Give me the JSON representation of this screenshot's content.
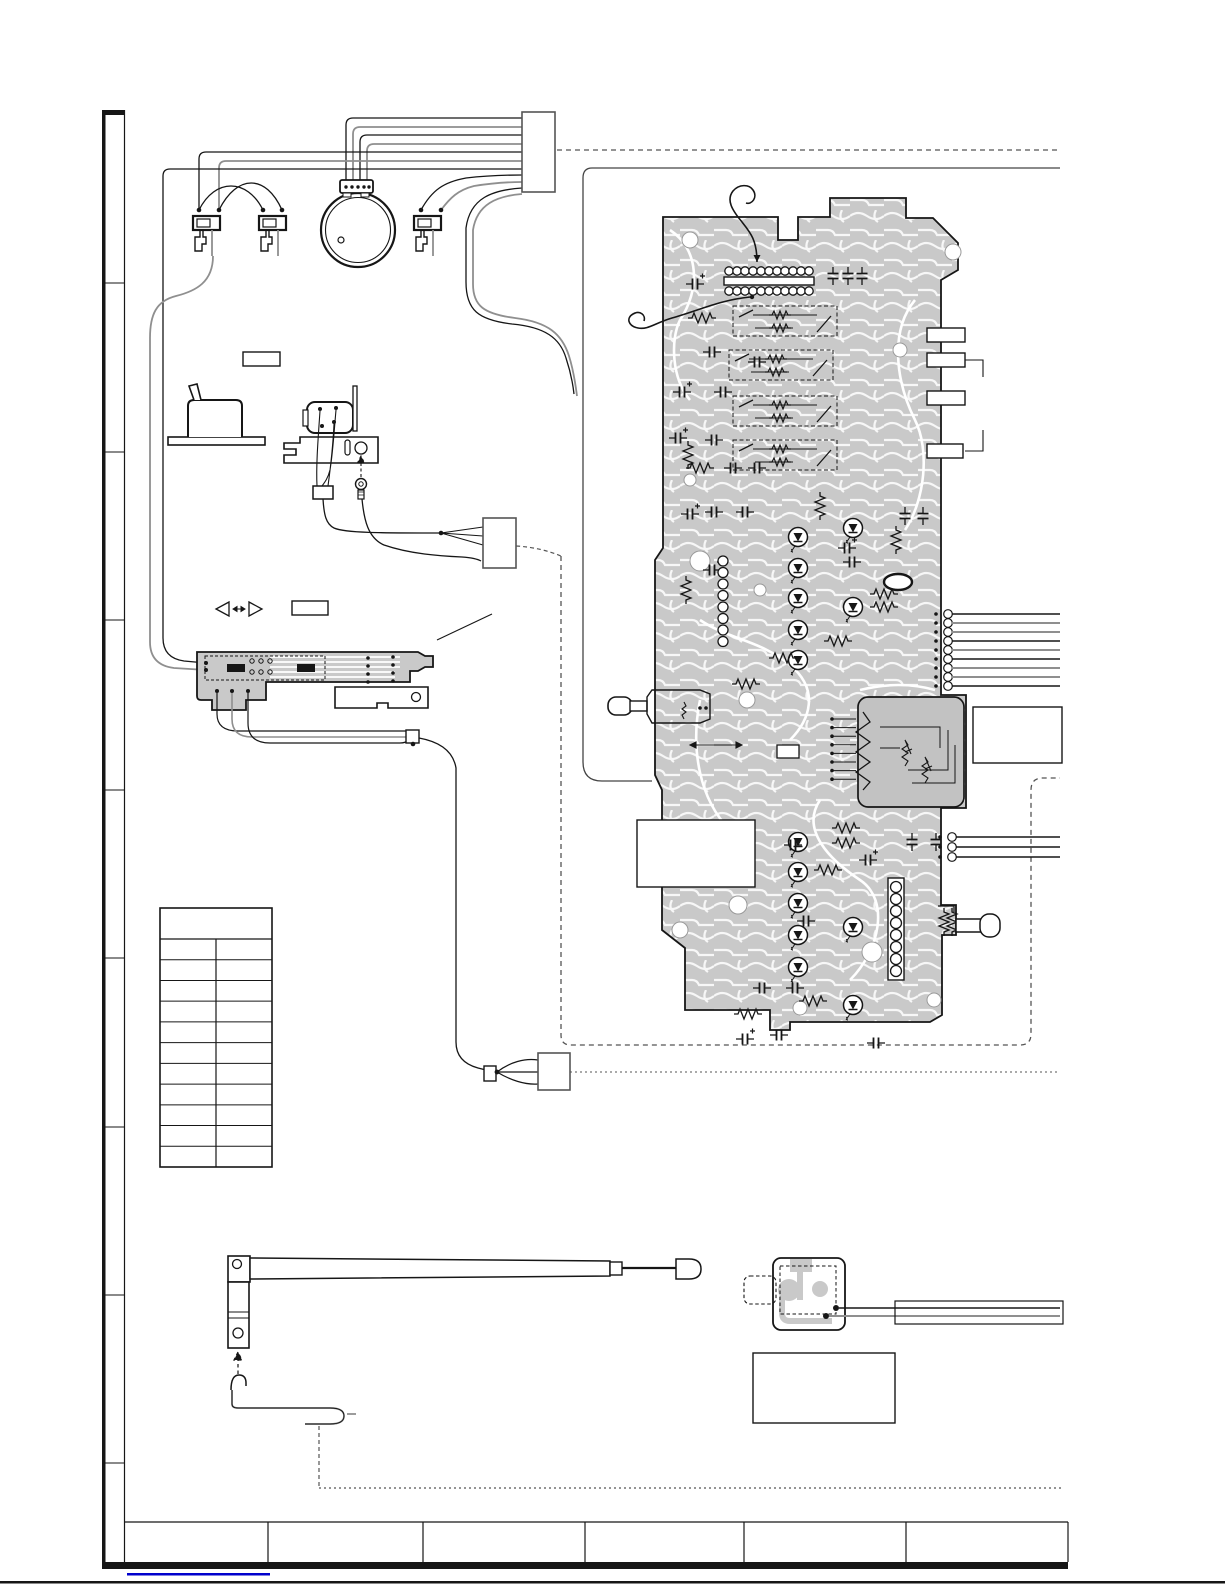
{
  "meta": {
    "kind": "service-manual-wiring-diagram-page",
    "visible_text": "",
    "page_width": 1225,
    "page_height": 1585
  },
  "colors": {
    "bg": "#ffffff",
    "ink": "#161616",
    "wire_gray": "#8f8f8f",
    "frame_gray": "#444444",
    "dash_gray": "#555555",
    "pcb_fill": "#c9c9c9",
    "pcb_block": "#c2c2c2",
    "trace_white": "#ffffff",
    "link_blue": "#0000cc"
  },
  "frame": {
    "strip_x": 102,
    "strip_x2": 124.5,
    "strip_top": 110,
    "strip_bottom": 1562,
    "dividers": [
      283,
      452,
      620,
      790,
      958,
      1127,
      1295,
      1463
    ],
    "footer": {
      "x1": 125,
      "x2": 1068,
      "y_top": 1522,
      "y_bottom": 1562,
      "dividers": [
        268,
        423,
        585,
        744,
        906
      ]
    },
    "bottom_bar": {
      "x1": 102,
      "x2": 1068,
      "y": 1562,
      "h": 7
    },
    "blue_line": {
      "x1": 127,
      "x2": 270,
      "y": 1573
    },
    "page_bottom_line_y": 1581
  },
  "ref_table": {
    "x": 160,
    "y": 908,
    "w": 112,
    "h": 259,
    "header_h": 31,
    "rows": 11,
    "col_split_x": 216,
    "cells_empty": true
  },
  "connectors": {
    "top": [
      522,
      112,
      33,
      80
    ],
    "mid": [
      483,
      518,
      33,
      50
    ],
    "lower": [
      538,
      1053,
      32,
      37
    ]
  },
  "label_boxes": [
    [
      243,
      352,
      37,
      14
    ],
    [
      292,
      601,
      36,
      14
    ],
    [
      927,
      328,
      38,
      14
    ],
    [
      927,
      353,
      38,
      14
    ],
    [
      927,
      391,
      38,
      14
    ],
    [
      927,
      444,
      36,
      14
    ],
    [
      973,
      707,
      89,
      56
    ],
    [
      637,
      820,
      118,
      67
    ],
    [
      753,
      1353,
      142,
      70
    ]
  ],
  "harness": {
    "wire_ys": [
      118,
      127,
      135,
      144,
      152,
      161,
      169
    ],
    "wire_colors": [
      "k",
      "g",
      "k",
      "g",
      "k",
      "g",
      "k"
    ],
    "motor_pins": [
      346,
      353,
      360,
      367
    ],
    "switch_dots": [
      [
        199,
        210
      ],
      [
        219,
        210
      ],
      [
        263,
        210
      ],
      [
        282,
        210
      ],
      [
        421,
        210
      ],
      [
        441,
        210
      ]
    ]
  },
  "bundles": [
    {
      "x": 948,
      "x_end": 1060,
      "ys": [
        614,
        623,
        632,
        641,
        650,
        659,
        668,
        677,
        686
      ],
      "colors": [
        "k",
        "g",
        "g",
        "k",
        "g",
        "k",
        "g",
        "g",
        "k"
      ]
    },
    {
      "x": 952,
      "x_end": 1060,
      "ys": [
        837,
        847,
        857
      ],
      "colors": [
        "k",
        "k",
        "k"
      ]
    }
  ],
  "leds": [
    [
      798,
      537
    ],
    [
      798,
      568
    ],
    [
      798,
      598
    ],
    [
      798,
      630
    ],
    [
      798,
      660
    ],
    [
      853,
      528
    ],
    [
      853,
      607
    ],
    [
      798,
      842
    ],
    [
      798,
      872
    ],
    [
      798,
      903
    ],
    [
      798,
      935
    ],
    [
      798,
      967
    ],
    [
      853,
      927
    ],
    [
      853,
      1005
    ]
  ],
  "pin_strip": {
    "x0": 729,
    "step": 8,
    "count": 11,
    "y_top": 271,
    "y_bot": 291,
    "bar": [
      724,
      277,
      90,
      8
    ]
  },
  "circle_cols": [
    {
      "x": 723,
      "y0": 561,
      "step": 11.5,
      "count": 8,
      "r": 5,
      "boxed": false
    },
    {
      "x": 896,
      "y0": 887,
      "step": 12,
      "count": 8,
      "r": 5.5,
      "boxed": true
    }
  ],
  "switch_rows": [
    [
      733,
      306
    ],
    [
      729,
      350
    ],
    [
      733,
      396
    ],
    [
      733,
      440
    ]
  ],
  "resistors": [
    [
      702,
      318,
      0
    ],
    [
      700,
      468,
      0
    ],
    [
      884,
      594,
      0
    ],
    [
      884,
      607,
      0
    ],
    [
      846,
      828,
      0
    ],
    [
      846,
      843,
      0
    ],
    [
      828,
      870,
      0
    ],
    [
      813,
      1001,
      0
    ],
    [
      748,
      1014,
      0
    ],
    [
      838,
      641,
      0
    ],
    [
      783,
      658,
      0
    ],
    [
      746,
      684,
      0
    ],
    [
      688,
      455,
      90
    ],
    [
      686,
      590,
      90
    ],
    [
      820,
      506,
      90
    ],
    [
      944,
      922,
      90
    ],
    [
      952,
      922,
      90
    ],
    [
      896,
      540,
      90
    ]
  ],
  "capacitors": [
    [
      833,
      276,
      90
    ],
    [
      848,
      276,
      90
    ],
    [
      862,
      276,
      90
    ],
    [
      712,
      352,
      0
    ],
    [
      757,
      362,
      0
    ],
    [
      723,
      392,
      0
    ],
    [
      714,
      440,
      0
    ],
    [
      733,
      468,
      0
    ],
    [
      757,
      468,
      0
    ],
    [
      714,
      512,
      0
    ],
    [
      745,
      512,
      0
    ],
    [
      793,
      845,
      0
    ],
    [
      762,
      988,
      0
    ],
    [
      795,
      988,
      0
    ],
    [
      912,
      842,
      90
    ],
    [
      936,
      842,
      90
    ],
    [
      905,
      516,
      90
    ],
    [
      923,
      516,
      90
    ],
    [
      852,
      562,
      0
    ],
    [
      876,
      1043,
      0
    ],
    [
      806,
      921,
      0
    ],
    [
      779,
      1035,
      0
    ]
  ],
  "electrolytics": [
    [
      695,
      284
    ],
    [
      682,
      392
    ],
    [
      678,
      438
    ],
    [
      690,
      514
    ],
    [
      712,
      570
    ],
    [
      745,
      1039
    ],
    [
      702,
      847
    ],
    [
      868,
      860
    ],
    [
      847,
      548
    ]
  ],
  "holes": [
    [
      690,
      240,
      8
    ],
    [
      953,
      252,
      8
    ],
    [
      700,
      561,
      10
    ],
    [
      747,
      700,
      8
    ],
    [
      872,
      952,
      10
    ],
    [
      934,
      1000,
      7
    ],
    [
      680,
      930,
      8
    ],
    [
      760,
      590,
      6
    ],
    [
      690,
      480,
      6
    ],
    [
      900,
      350,
      7
    ],
    [
      738,
      905,
      9
    ],
    [
      800,
      1008,
      7
    ]
  ],
  "fan_pins": {
    "x": 832,
    "y0": 719,
    "step": 8.6,
    "count": 8,
    "len": 24
  }
}
